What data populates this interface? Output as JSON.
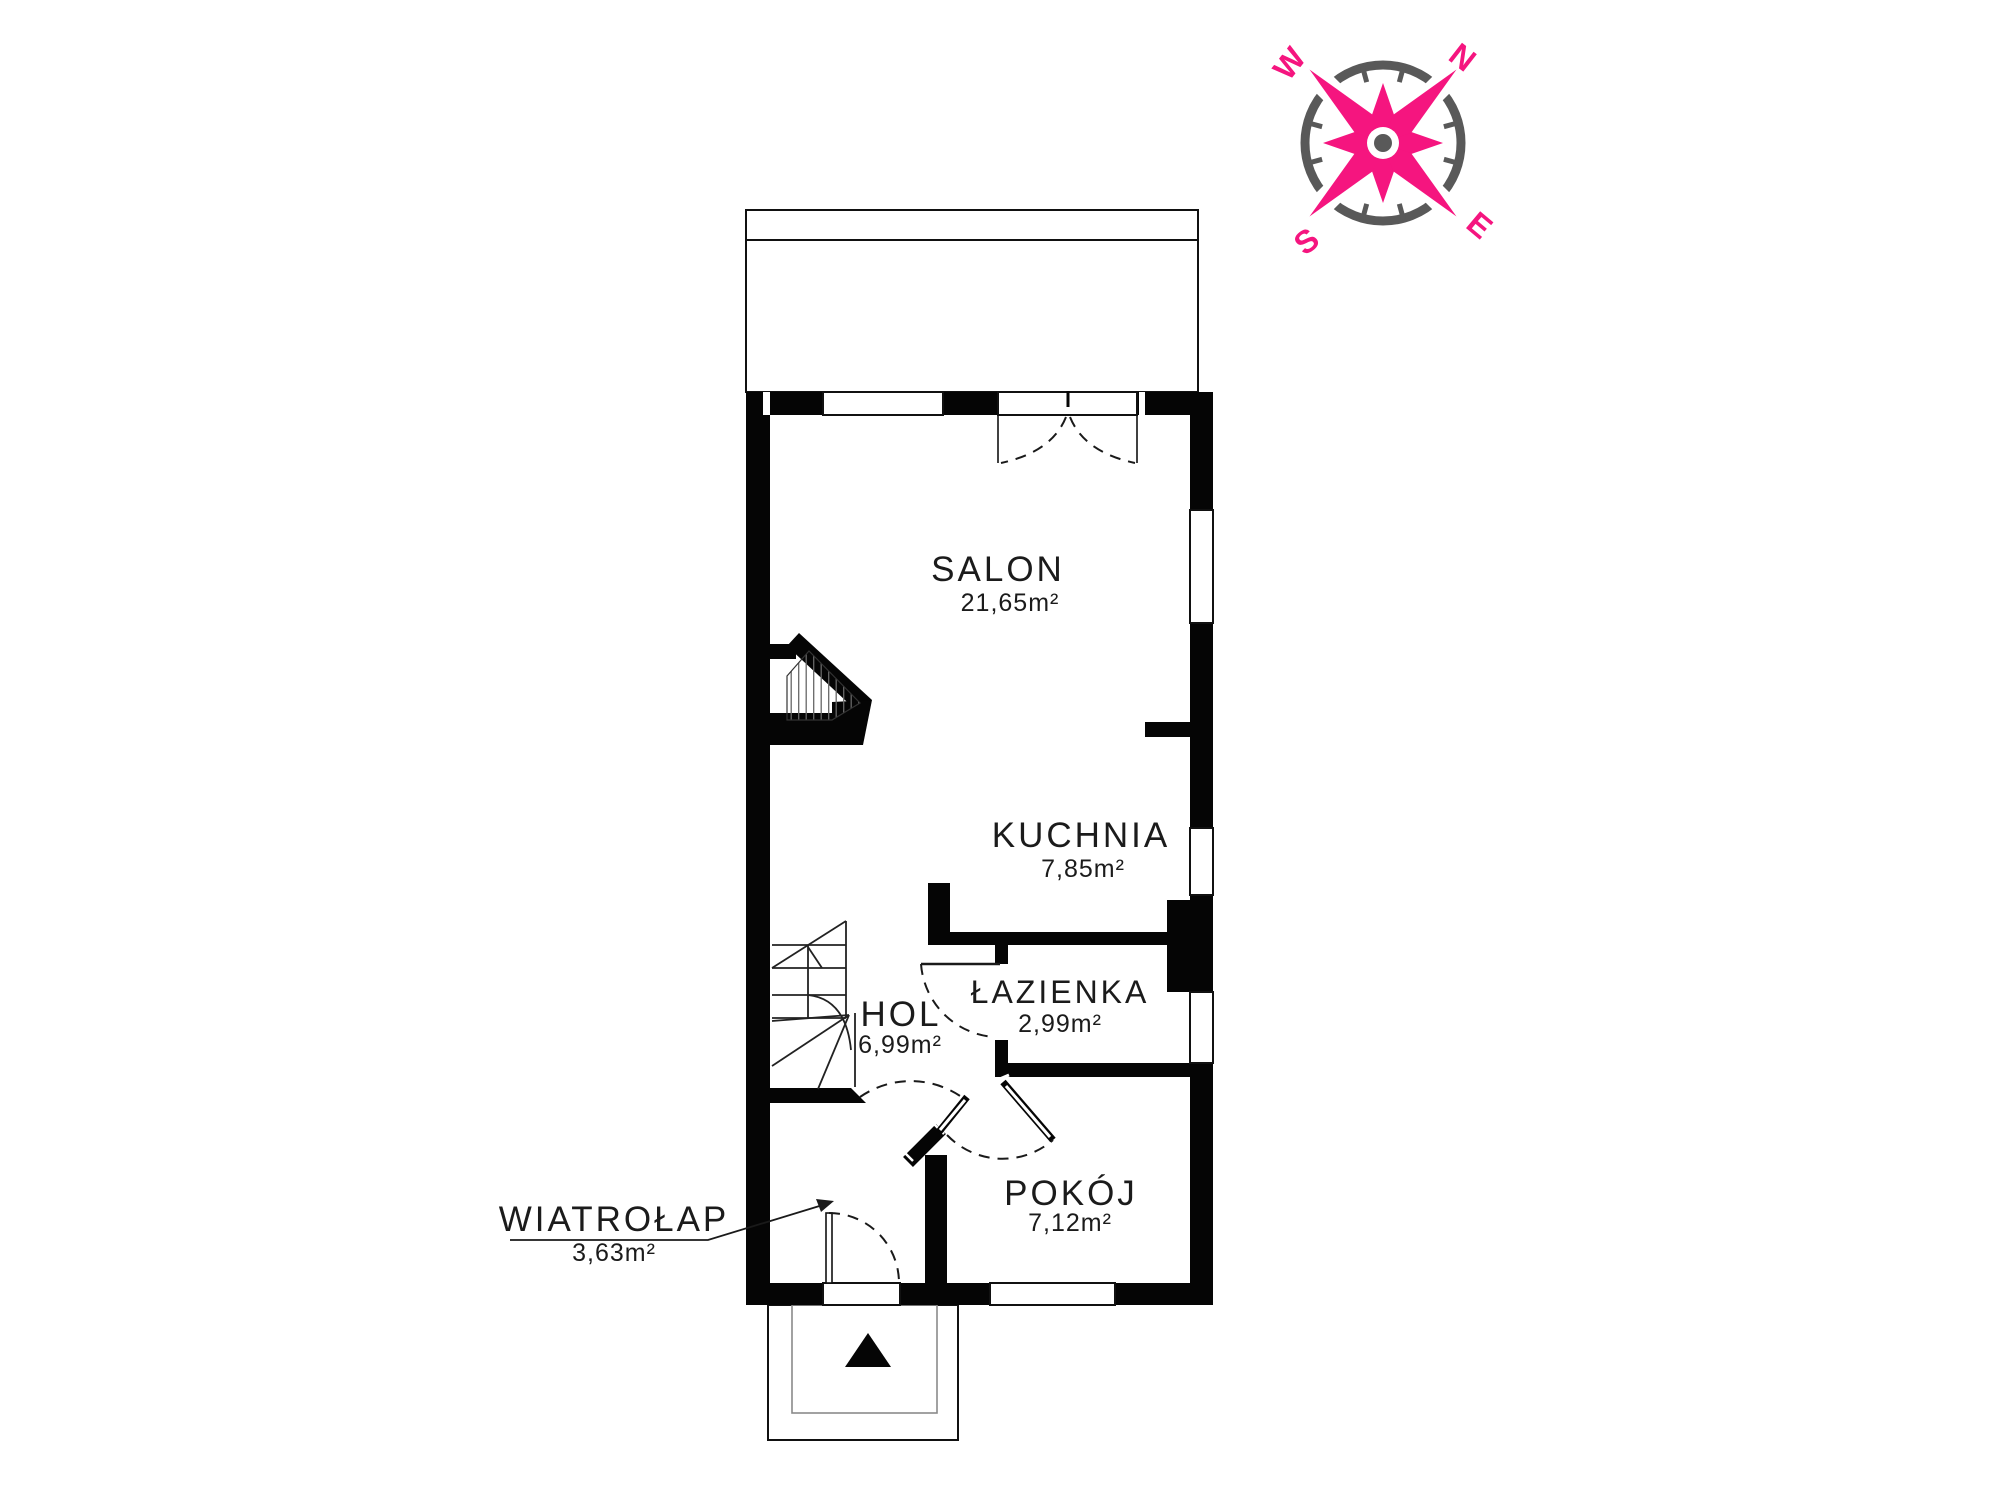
{
  "plan": {
    "rooms": [
      {
        "name": "SALON",
        "area": "21,65m²"
      },
      {
        "name": "KUCHNIA",
        "area": "7,85m²"
      },
      {
        "name": "ŁAZIENKA",
        "area": "2,99m²"
      },
      {
        "name": "HOL",
        "area": "6,99m²"
      },
      {
        "name": "POKÓJ",
        "area": "7,12m²"
      },
      {
        "name": "WIATROŁAP",
        "area": "3,63m²"
      }
    ]
  },
  "compass": {
    "north": "N",
    "east": "E",
    "south": "S",
    "west": "W",
    "star_color": "#f5157f",
    "ring_color": "#595959"
  },
  "colors": {
    "walls": "#050505",
    "background": "#ffffff"
  }
}
